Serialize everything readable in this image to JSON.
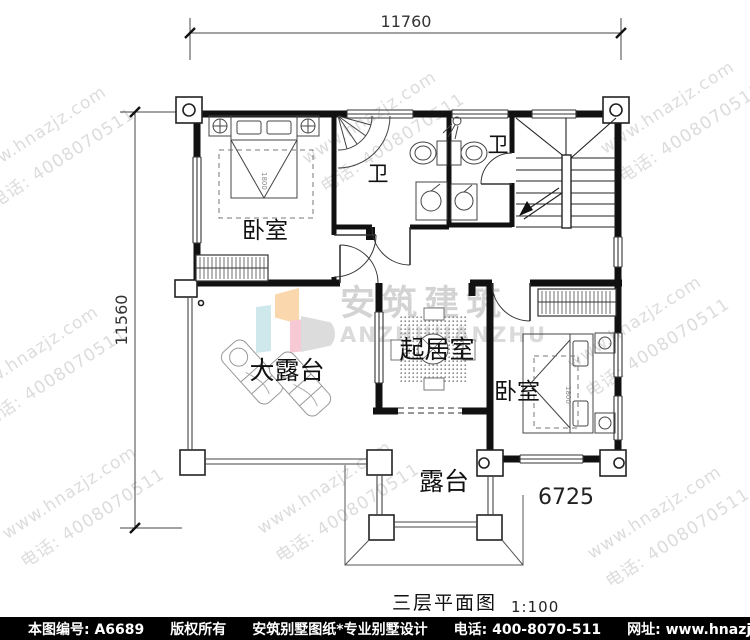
{
  "plan": {
    "dims": {
      "top": "11760",
      "left": "11560",
      "inner": "6725"
    },
    "rooms": {
      "bedroom_left": "卧室",
      "bath1": "卫",
      "bath2": "卫",
      "living": "起居室",
      "bedroom_right": "卧室",
      "terrace_large": "大露台",
      "terrace": "露台"
    },
    "bed_size": "1800",
    "title": "三层平面图",
    "scale": "1:100"
  },
  "watermark": {
    "site": "www.hnazjz.com",
    "phone": "电话: 4008070511",
    "logo_cn": "安筑建筑",
    "logo_en": "ANZHUJIANZHU"
  },
  "footer": {
    "number": "本图编号: A6689",
    "copyright": "版权所有",
    "brand": "安筑别墅图纸*专业别墅设计",
    "phone": "电话: 400-8070-511",
    "site": "网址: www.hnazjz.com"
  }
}
